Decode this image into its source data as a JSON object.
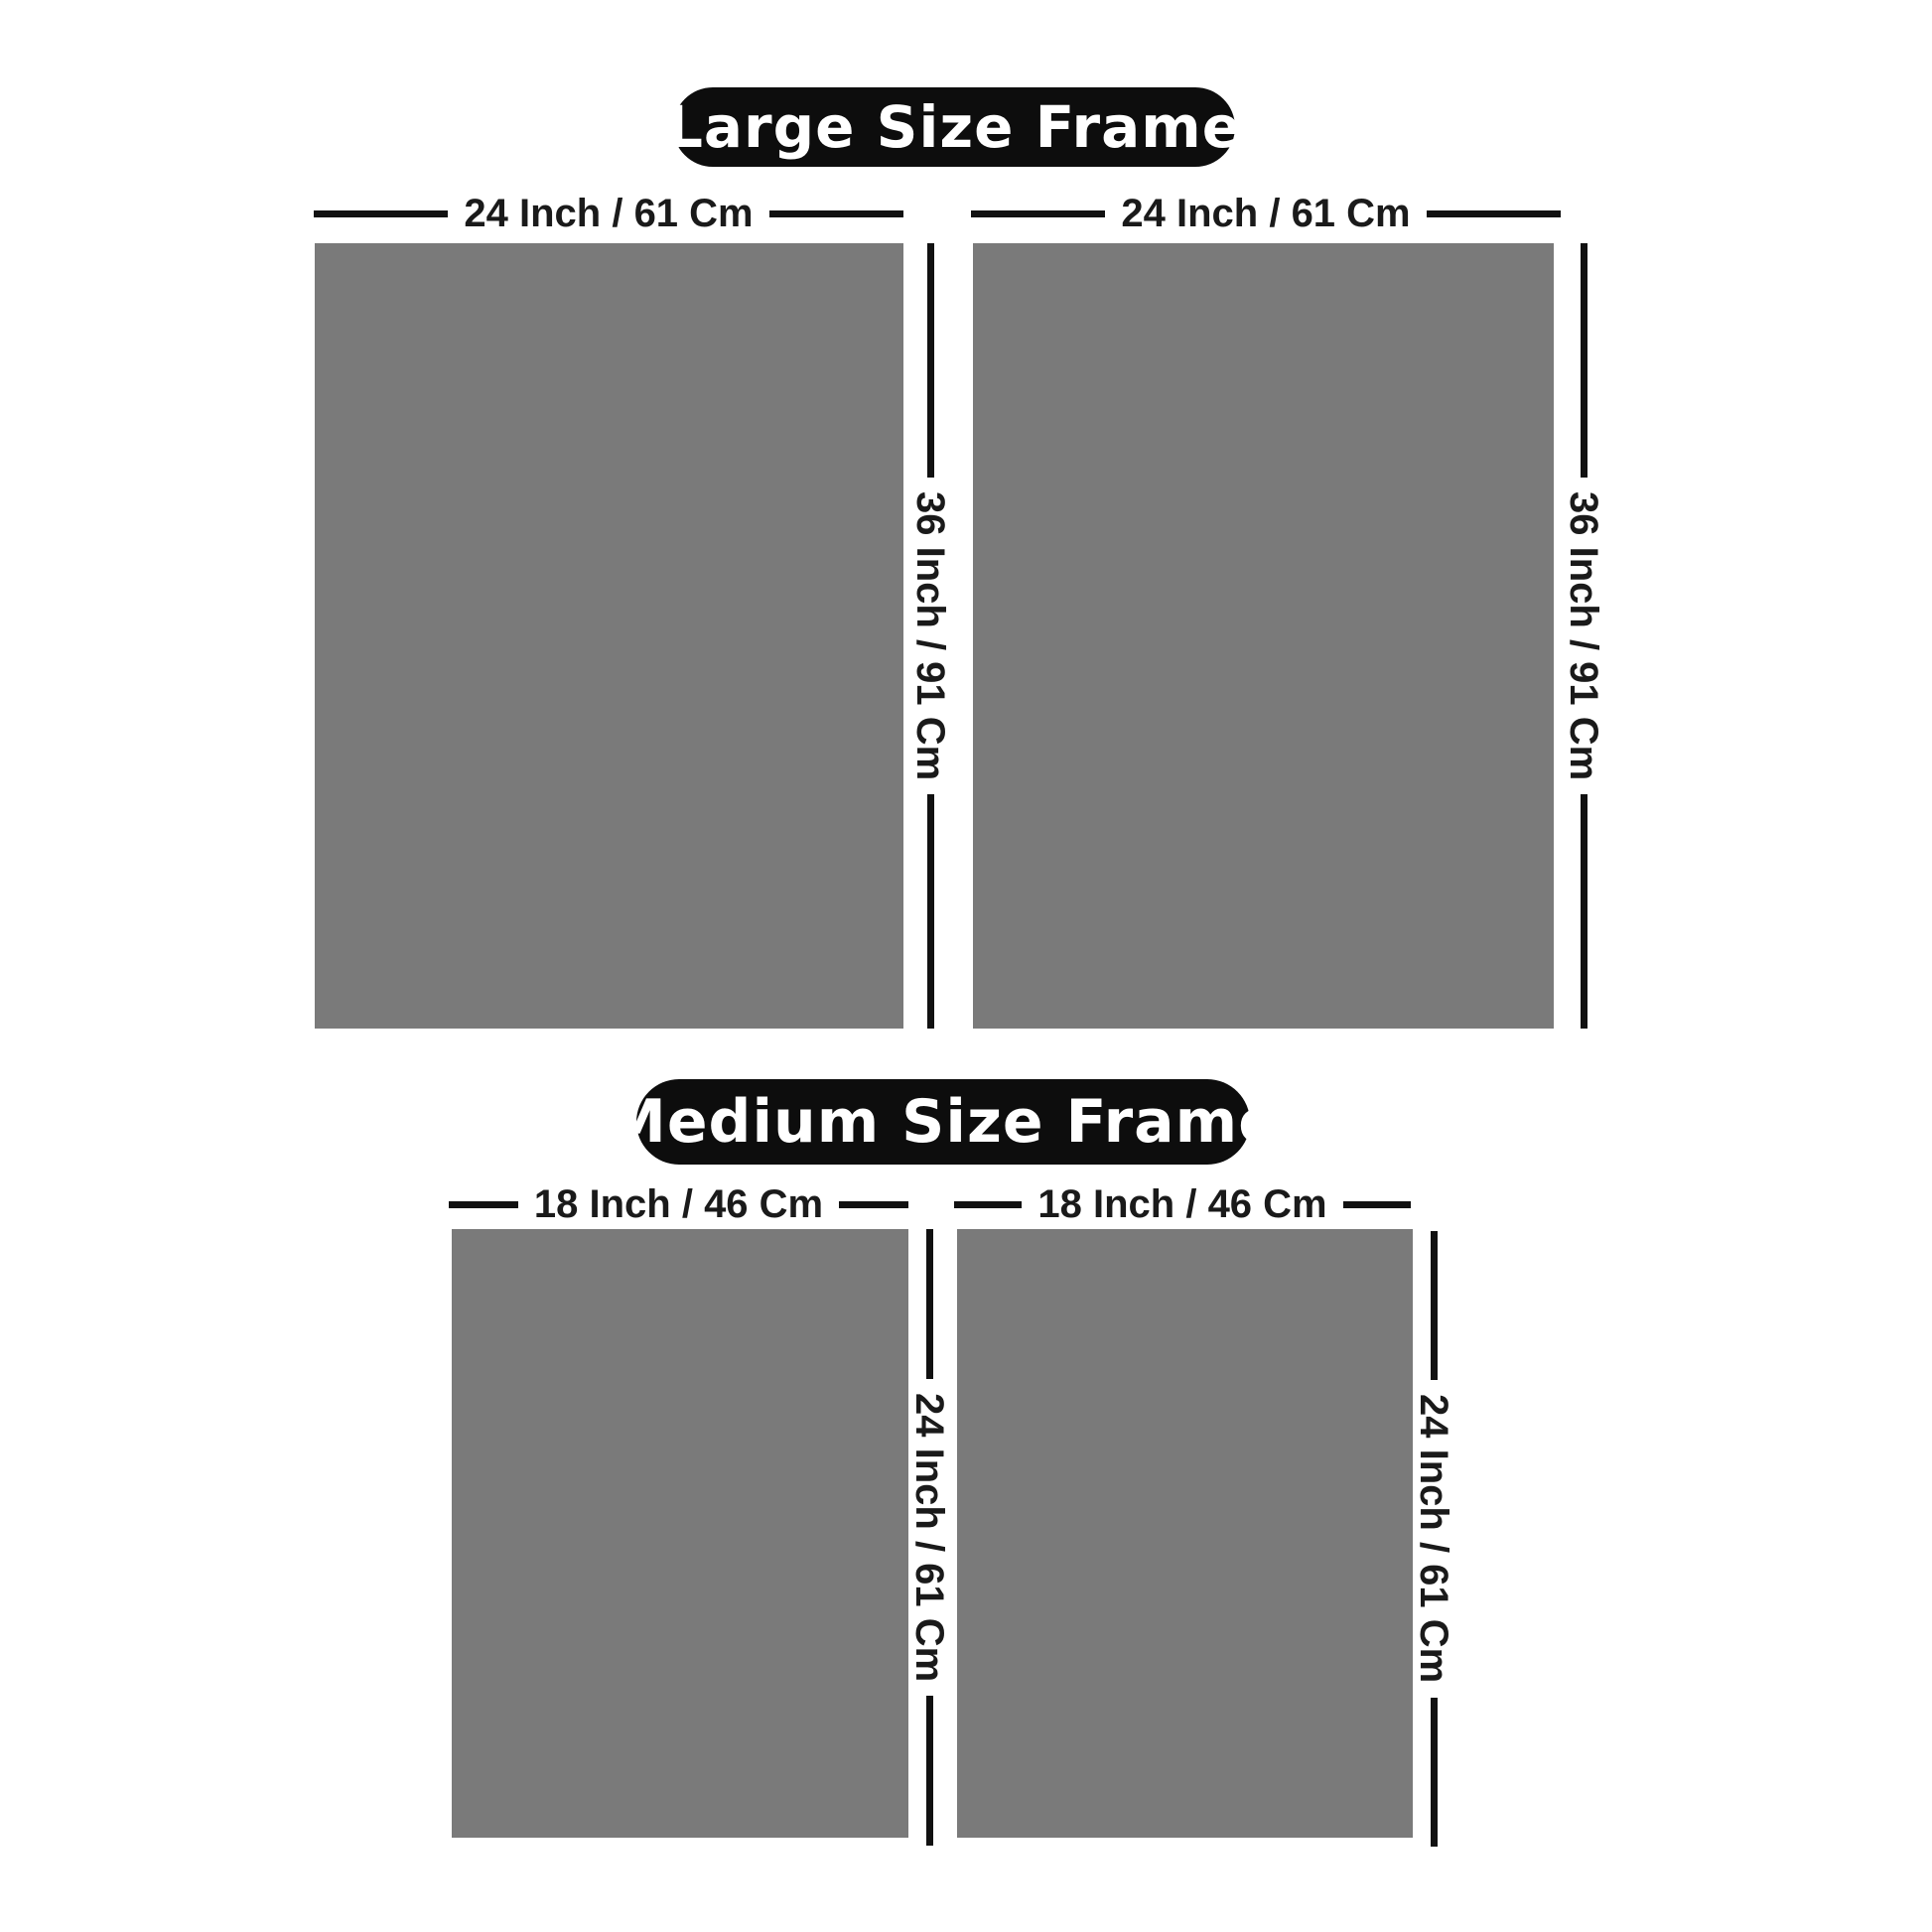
{
  "page": {
    "background": "#ffffff",
    "description_colors": {
      "frame_fill": "#7a7a7a",
      "dimension_line": "#111111",
      "pill_background": "#0d0d0d",
      "pill_text": "#ffffff",
      "label_text": "#1a1a1a"
    }
  },
  "sections": [
    {
      "id": "large",
      "title": "Large Size Frame",
      "width_label": "24 Inch / 61 Cm",
      "height_label": "36 Inch / 91 Cm",
      "frame_count": 2
    },
    {
      "id": "medium",
      "title": "Medium Size Frame",
      "width_label": "18 Inch / 46 Cm",
      "height_label": "24 Inch / 61 Cm",
      "frame_count": 2
    }
  ]
}
